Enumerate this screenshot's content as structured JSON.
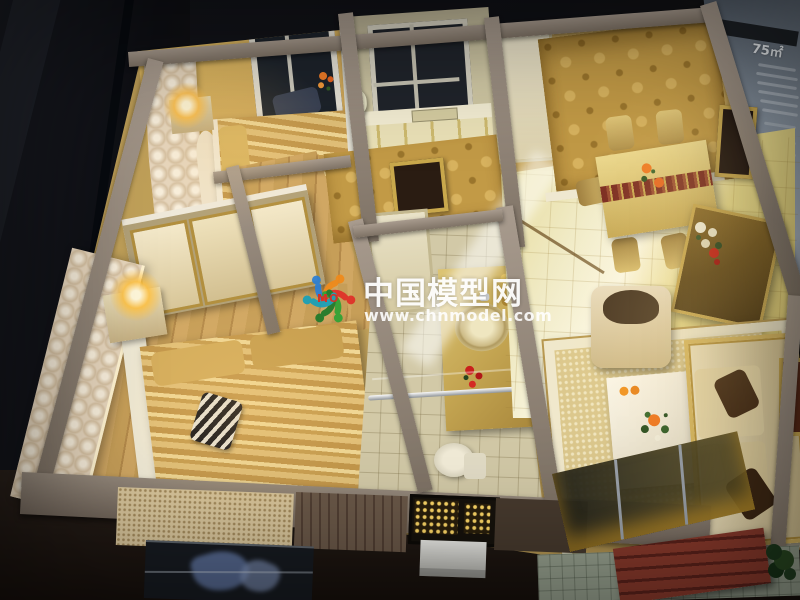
{
  "watermark": {
    "site_name": "中国模型网",
    "site_url": "www.chnmodel.com",
    "logo_text": "MO",
    "logo_icon": "circle-of-people-logo",
    "text_color": "#ffffff",
    "logo_text_color": "#d42b24",
    "logo_colors": [
      "#2b7fd6",
      "#f08a1a",
      "#e03028",
      "#2fa335",
      "#1f7a2a",
      "#18a0b8"
    ]
  },
  "background_sign": {
    "area_label": "75㎡",
    "panel_color": "#8d99a6",
    "text_color": "#eef2f6"
  },
  "model_palette": {
    "wall_top": "#948779",
    "wood_floor": "#c69e58",
    "gold_wallpaper": "#c29a46",
    "gloss_floor": "#f0eac4",
    "bedding_gold": "#d9b874",
    "sofa_cream": "#e9dcc0",
    "bench_red": "#7a2f24",
    "lamp_glow": "#ffd968"
  }
}
